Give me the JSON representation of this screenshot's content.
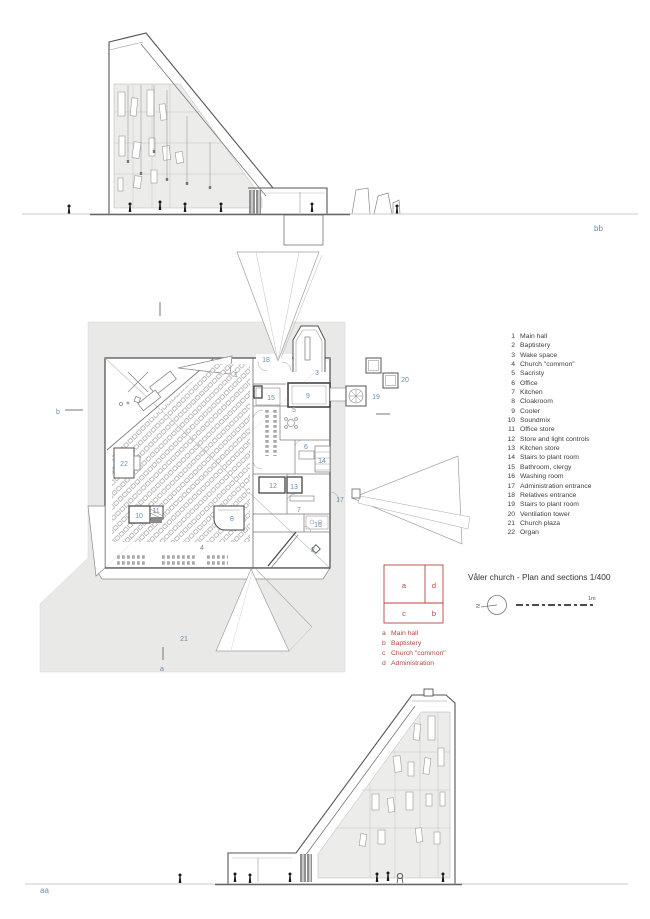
{
  "title": {
    "text": "Våler church - Plan and sections 1/400"
  },
  "north": {
    "label": "N"
  },
  "scalebar": {
    "label": "1m"
  },
  "sections": {
    "top_label": "bb",
    "bottom_label": "aa"
  },
  "plan": {
    "marker_a": "a",
    "marker_b": "b",
    "labels": [
      "1",
      "2",
      "3",
      "4",
      "5",
      "6",
      "7",
      "8",
      "9",
      "10",
      "11",
      "12",
      "13",
      "14",
      "15",
      "16",
      "17",
      "18",
      "19",
      "20",
      "21",
      "22"
    ]
  },
  "legend": {
    "items": [
      {
        "num": "1",
        "label": "Main hall"
      },
      {
        "num": "2",
        "label": "Baptistery"
      },
      {
        "num": "3",
        "label": "Wake space"
      },
      {
        "num": "4",
        "label": "Church \"common\""
      },
      {
        "num": "5",
        "label": "Sacristy"
      },
      {
        "num": "6",
        "label": "Office"
      },
      {
        "num": "7",
        "label": "Kitchen"
      },
      {
        "num": "8",
        "label": "Cloakroom"
      },
      {
        "num": "9",
        "label": "Cooler"
      },
      {
        "num": "10",
        "label": "Soundmix"
      },
      {
        "num": "11",
        "label": "Office store"
      },
      {
        "num": "12",
        "label": "Store and light controls"
      },
      {
        "num": "13",
        "label": "Kitchen store"
      },
      {
        "num": "14",
        "label": "Stairs to plant room"
      },
      {
        "num": "15",
        "label": "Bathroom, clergy"
      },
      {
        "num": "16",
        "label": "Washing room"
      },
      {
        "num": "17",
        "label": "Administration entrance"
      },
      {
        "num": "18",
        "label": "Relatives entrance"
      },
      {
        "num": "19",
        "label": "Stairs to plant room"
      },
      {
        "num": "20",
        "label": "Ventilation tower"
      },
      {
        "num": "21",
        "label": "Church plaza"
      },
      {
        "num": "22",
        "label": "Organ"
      }
    ]
  },
  "key": {
    "cells": {
      "a": "a",
      "b": "b",
      "c": "c",
      "d": "d"
    },
    "entries": [
      {
        "letter": "a",
        "label": "Main hall"
      },
      {
        "letter": "b",
        "label": "Baptistery"
      },
      {
        "letter": "c",
        "label": "Church \"common\""
      },
      {
        "letter": "d",
        "label": "Administration"
      }
    ]
  },
  "colors": {
    "blue": "#6a8dad",
    "red": "#b2473e",
    "plaza": "#e9e9e7",
    "wall": "#4a4a4a"
  }
}
